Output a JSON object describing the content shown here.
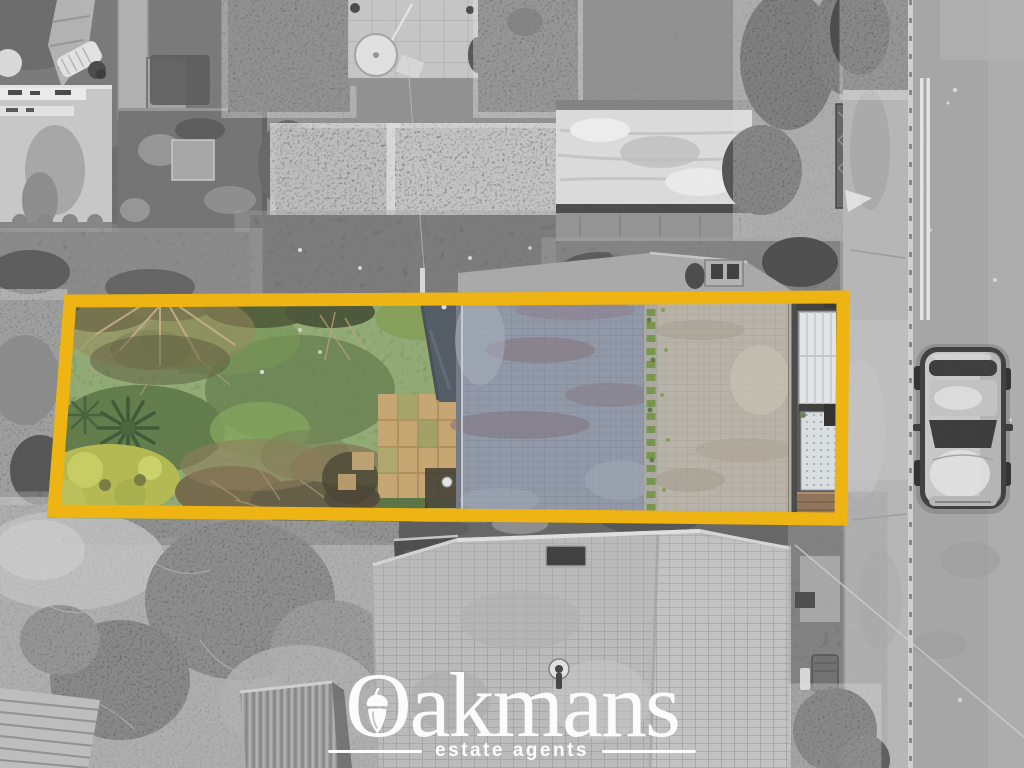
{
  "watermark": {
    "brand": "Oakmans",
    "brand_initial": "O",
    "brand_rest": "akmans",
    "tagline": "estate agents",
    "icon": "acorn-icon",
    "color": "#ffffff"
  },
  "annotation": {
    "type": "property-boundary-highlight",
    "shape": "quadrilateral",
    "color": "#edb414"
  },
  "scene": {
    "style": "aerial drone photograph of terraced housing plots",
    "treatment": "black-and-white photo; full colour only inside the highlighted plot",
    "palette": {
      "lawn_green": "#5c7f40",
      "shrub_yellow_green": "#b2b843",
      "slate_roof_blue_grey": "#8a93a4",
      "front_roof_beige": "#b7b1a5",
      "patio_tan": "#c7a266",
      "road_grey": "#a2a2a2",
      "pavement_grey": "#b4b4b4"
    },
    "objects": [
      "rear-garden-lawn",
      "bare-winter-tree",
      "palm-plant",
      "yellow-shrub",
      "garden-patio",
      "flat-roof-extension",
      "main-roof-slate-slope",
      "mossy-roof-ridge",
      "front-roof-slope",
      "conservatory",
      "porch",
      "road",
      "pavement",
      "kerb",
      "double-white-lines",
      "parked-car",
      "neighbour-hip-roof",
      "neighbour-garage",
      "garden-shed",
      "decking",
      "garden-table-and-chairs",
      "white-flat-roof-outbuilding",
      "hedges",
      "power-line"
    ]
  }
}
